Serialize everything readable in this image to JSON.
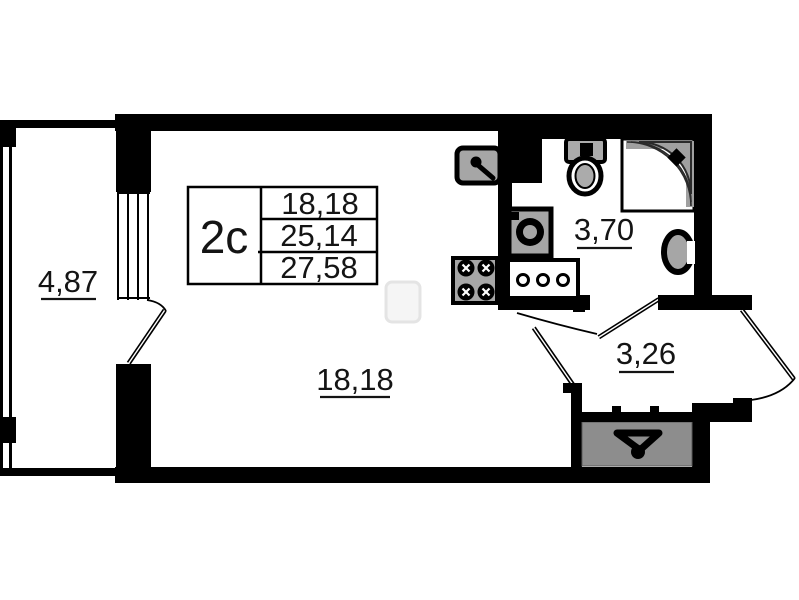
{
  "legend": {
    "unit_type": "2с",
    "values": [
      "18,18",
      "25,14",
      "27,58"
    ]
  },
  "rooms": {
    "living_room": "18,18",
    "balcony": "4,87",
    "bathroom": "3,70",
    "hallway": "3,26"
  },
  "fixtures": [
    "kitchen-sink",
    "cooktop",
    "kitchen-counter",
    "washing-machine",
    "toilet",
    "shower-cabin",
    "wash-basin",
    "entrance-mat",
    "entrance-arrow"
  ],
  "colors": {
    "walls": "#000000",
    "fixture_gray": "#a6a6a6",
    "shower_gray": "#a0a0a0",
    "mat_gray": "#8d8d8d",
    "text": "#141414"
  }
}
